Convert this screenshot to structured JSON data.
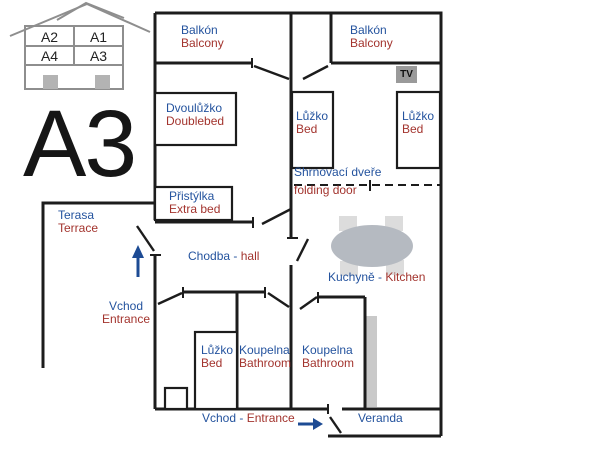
{
  "apartment": {
    "title": "A3"
  },
  "building_key": {
    "top_left": "A2",
    "top_right": "A1",
    "bottom_left": "A4",
    "bottom_right": "A3"
  },
  "labels": {
    "balcony_left": {
      "cz": "Balkón",
      "en": "Balcony"
    },
    "balcony_right": {
      "cz": "Balkón",
      "en": "Balcony"
    },
    "doublebed_room": {
      "cz": "Dvoulůžko",
      "en": "Doublebed"
    },
    "bed_top_left": {
      "cz": "Lůžko",
      "en": "Bed"
    },
    "bed_top_right": {
      "cz": "Lůžko",
      "en": "Bed"
    },
    "folding_door": {
      "cz": "Shrnovací dveře",
      "en": "folding door"
    },
    "extra_bed": {
      "cz": "Přistýlka",
      "en": "Extra bed"
    },
    "terrace": {
      "cz": "Terasa",
      "en": "Terrace"
    },
    "hall": {
      "cz": "Chodba -",
      "en": "hall"
    },
    "entrance_side": {
      "cz": "Vchod",
      "en": "Entrance"
    },
    "bed_bottom": {
      "cz": "Lůžko",
      "en": "Bed"
    },
    "bathroom_1": {
      "cz": "Koupelna",
      "en": "Bathroom"
    },
    "bathroom_2": {
      "cz": "Koupelna",
      "en": "Bathroom"
    },
    "kitchen": {
      "cz": "Kuchyně -",
      "en": "Kitchen"
    },
    "entrance_bottom": {
      "cz": "Vchod -",
      "en": "Entrance"
    },
    "veranda": {
      "cz": "Veranda"
    },
    "tv": "TV"
  },
  "colors": {
    "czech_label": "#24539e",
    "english_label": "#a3342e",
    "wall": "#1c1c1c",
    "arrow_blue": "#1d4b94",
    "table_fill": "#b5bac1",
    "chair_fill": "#dcdcdc",
    "strip_fill": "#c9c9c9",
    "tv_fill": "#9a9a9a",
    "house_icon_gray": "#8e8e8e",
    "house_square_gray": "#b3b3b3"
  }
}
